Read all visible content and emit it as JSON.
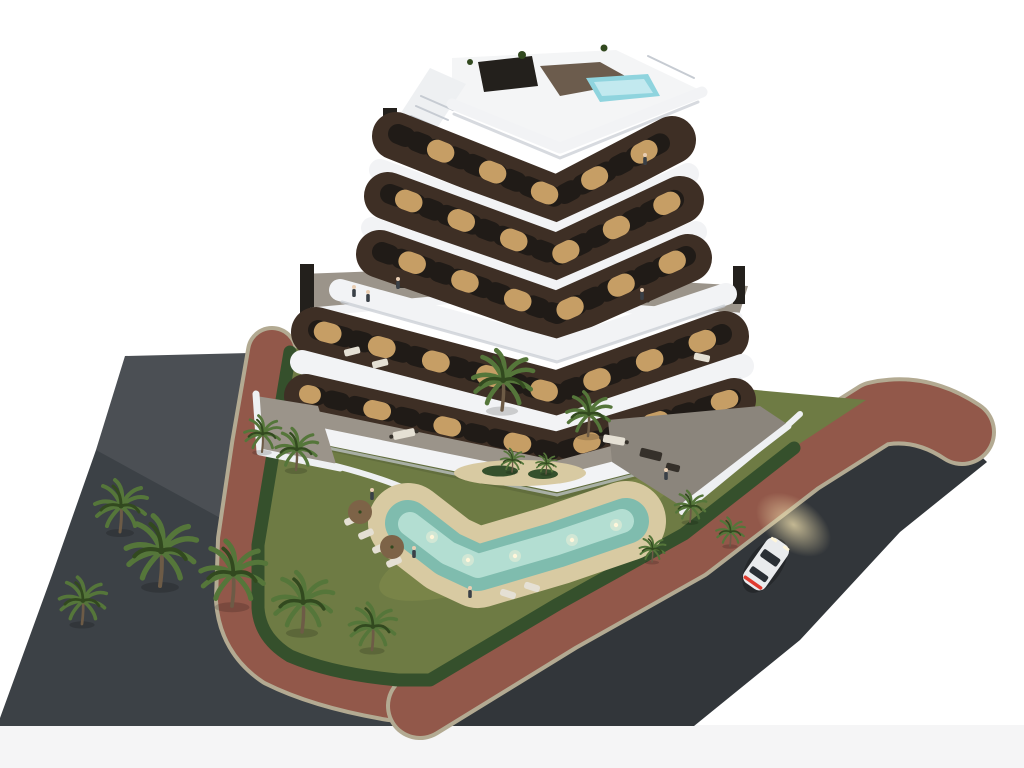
{
  "scene": {
    "type": "3d-architectural-render",
    "description": "Aerial dusk rendering of a modern apartment building with a dark brown facade and curved white wrap-around balconies, set in a walled corner plot with a landscaped garden, free-form illuminated swimming pool, sandy pool deck with sun loungers and parasols, palm trees, hedge borders, red paved sidewalks and two asphalt streets with a white car driving with its headlights on",
    "time_of_day": "dusk",
    "building": {
      "floors_visible": 6,
      "facade": "dark chocolate brown with lit windows",
      "balconies": "white rounded wavy bands on every floor",
      "rooftop_features": [
        "roof terrace",
        "plunge pool",
        "dark pergola",
        "external staircase",
        "chimneys",
        "planters"
      ],
      "terraces": "large furnished terraces with outdoor sofas and dining tables",
      "people_visible": true
    },
    "garden": {
      "features": [
        "free-form swimming pool with underwater lights",
        "sand-colored pool beach",
        "sun loungers",
        "parasols",
        "island planter with small palms",
        "lawn",
        "dense hedge border",
        "white perimeter walls",
        "palm trees"
      ]
    },
    "streets": {
      "streets_count": 2,
      "surface": "dark asphalt",
      "sidewalk": "red-brown pavement with light curb",
      "vehicle": {
        "type": "car",
        "color": "white",
        "state": "driving with headlights on and red taillights lit"
      }
    }
  },
  "colors": {
    "background": "#ffffff",
    "canvas_edge": "#f5f5f6",
    "asphalt": "#3c4146",
    "sidewalk": "#92584a",
    "curb": "#b3aa92",
    "lawn": "#6e7b44",
    "lawn_light": "#87914e",
    "hedge": "#35502c",
    "verge": "#7c7553",
    "palm_frond": "#55763a",
    "palm_frond_dark": "#32491f",
    "palm_trunk": "#6d5b46",
    "sand": "#d8caa2",
    "pool_water": "#7fbcae",
    "pool_water_light": "#bce4d8",
    "pool_light": "#fff6da",
    "facade": "#3e2f25",
    "facade_side": "#54412f",
    "balcony": "#f2f3f5",
    "balcony_shadow": "#c6cbd2",
    "roof_deck": "#f4f5f6",
    "roof_pool": "#8fd4de",
    "roof_pool_light": "#c2e9ef",
    "pergola": "#23201c",
    "window": "#201b17",
    "window_lit": "#d8ad6e",
    "terrace_floor": "#9b948a",
    "terrace_floor_dark": "#8b857c",
    "wall_white": "#eef0f2",
    "sofa": "#35302a",
    "lounger": "#e5e0d4",
    "parasol": "#7d6347",
    "skin": "#e8cdb2",
    "person_dark": "#3a4047",
    "car_body": "#e9ebed",
    "car_glass": "#2a2f35",
    "car_taillight": "#e03b2f",
    "headlight_glow": "#f4e3b0"
  }
}
